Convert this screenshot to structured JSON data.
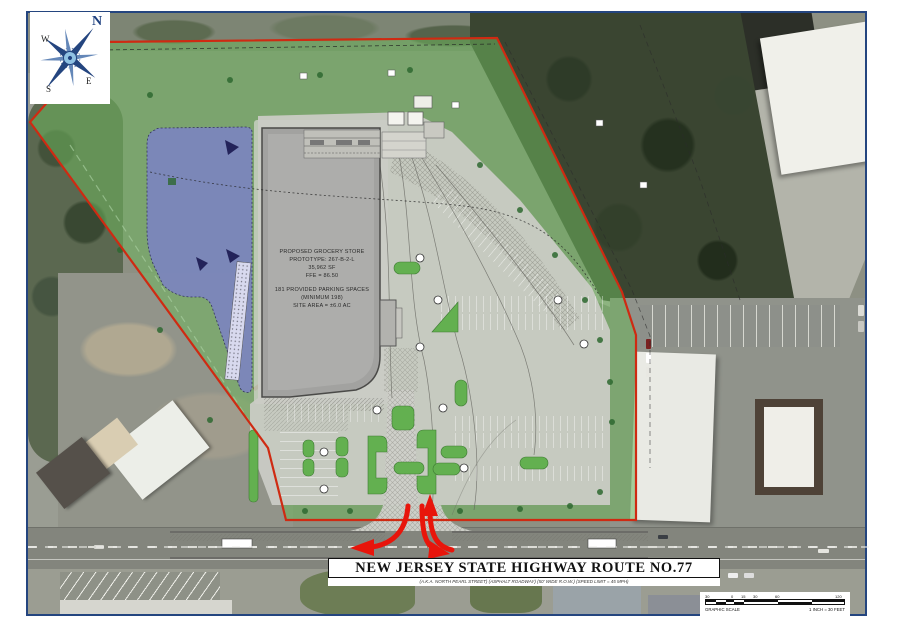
{
  "drawing": {
    "compass": {
      "n": "N",
      "w": "W",
      "s": "S",
      "e": "E"
    },
    "building_label": {
      "lines": [
        "PROPOSED GROCERY STORE",
        "PROTOTYPE: 267-B-2-L",
        "35,962 SF",
        "FFE = 86.50",
        "181 PROVIDED PARKING SPACES",
        "(MINIMUM 198)",
        "SITE AREA = ±6.0 AC"
      ]
    },
    "highway": {
      "name": "NEW JERSEY STATE HIGHWAY ROUTE NO.77",
      "details": "(A.K.A. NORTH PEARL STREET)   (ASPHALT ROADWAY)   (50' WIDE R.O.W.)   (SPEED LIMIT = 45 MPH)"
    },
    "scale_bar": {
      "title": "GRAPHIC SCALE",
      "ratio": "1 INCH = 30 FEET",
      "ticks": [
        "30",
        "0",
        "15",
        "30",
        "60",
        "120"
      ]
    }
  },
  "colors": {
    "frame_blue": "#24457f",
    "site_green": "#6db45c",
    "island_green": "#63b050",
    "basin_blue": "#7b80c8",
    "boundary_red": "#cf2a12",
    "arrow_red": "#e8150b",
    "building_gray": "#a2a2a0",
    "pavement_gray": "#cbccc6"
  }
}
